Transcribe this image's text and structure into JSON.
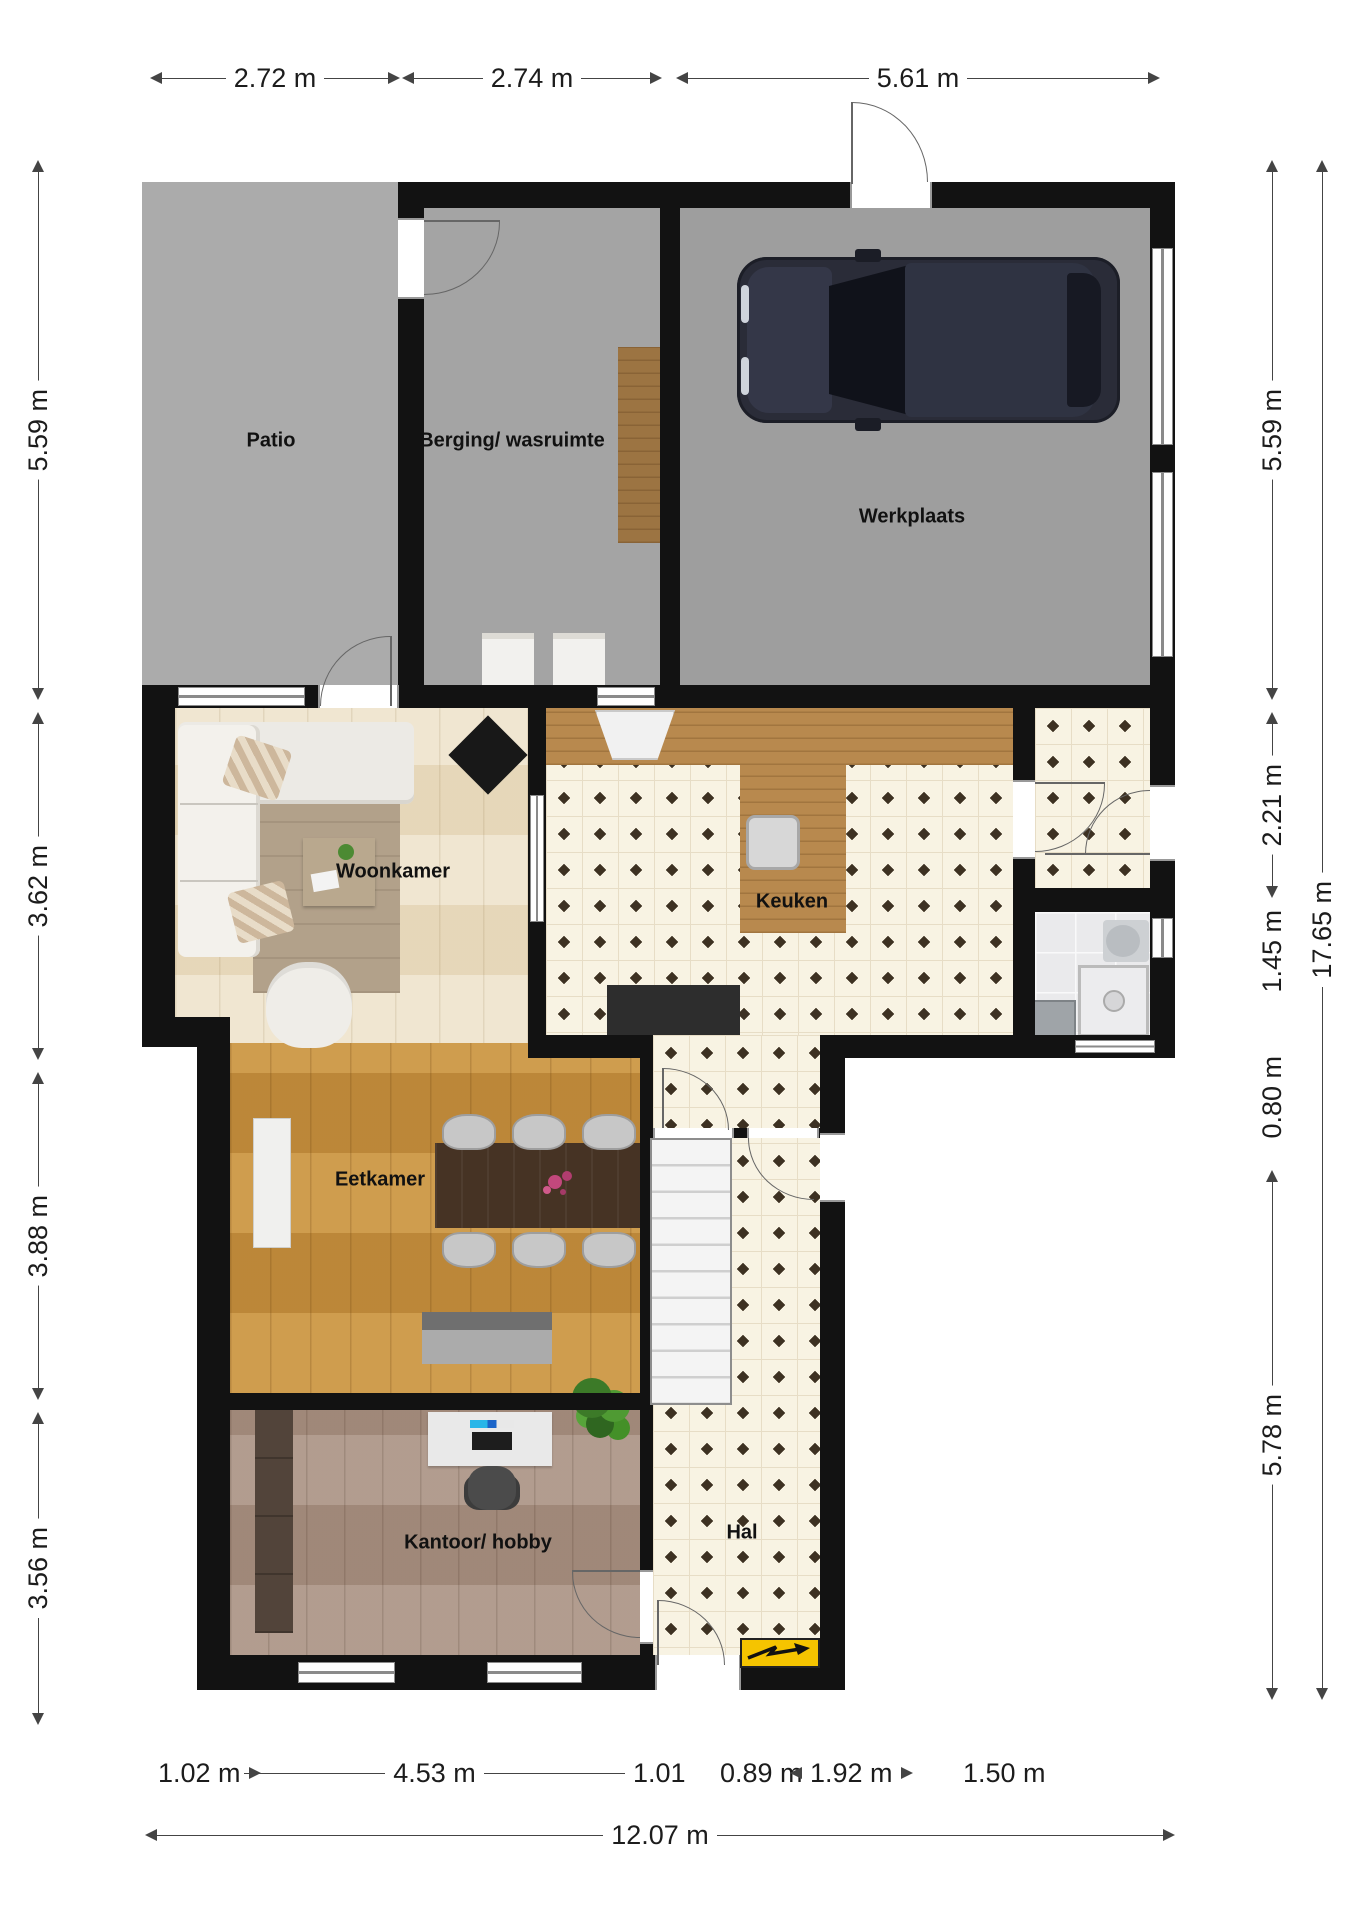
{
  "plan_title": "Begane grond plattegrond",
  "rooms": [
    {
      "name": "Patio"
    },
    {
      "name": "Berging/ wasruimte"
    },
    {
      "name": "Werkplaats"
    },
    {
      "name": "Woonkamer"
    },
    {
      "name": "Keuken"
    },
    {
      "name": "Eetkamer"
    },
    {
      "name": "Kantoor/ hobby"
    },
    {
      "name": "Hal"
    }
  ],
  "dimensions": {
    "top": [
      "2.72 m",
      "2.74 m",
      "5.61 m"
    ],
    "left": [
      "5.59 m",
      "3.62 m",
      "3.88 m",
      "3.56 m"
    ],
    "right": [
      "5.59 m",
      "2.21 m",
      "1.45 m",
      "0.80 m",
      "5.78 m"
    ],
    "right_total": "17.65 m",
    "bottom": [
      "1.02 m",
      "4.53 m",
      "1.01",
      "0.89 m",
      "1.92 m",
      "1.50 m"
    ],
    "bottom_total": "12.07 m"
  },
  "icons": {
    "meter_box": "electric-meter-zigzag-arrow",
    "car": "car-top-view",
    "stairs": "staircase"
  },
  "colors": {
    "wall": "#121212",
    "tile_diamond": "#3d3122",
    "tile_background": "#f8f3e3",
    "patio_floor": "#ababab",
    "berging_floor": "#a4a4a4",
    "werkplaats_floor": "#9e9e9e",
    "woonkamer_wood": "#ecdfc4",
    "eetkamer_wood": "#c7903e",
    "kantoor_wood": "#a78f80",
    "counter_wood": "#b8894e",
    "meter_yellow": "#f5c400",
    "car_body": "#2a2c38"
  }
}
